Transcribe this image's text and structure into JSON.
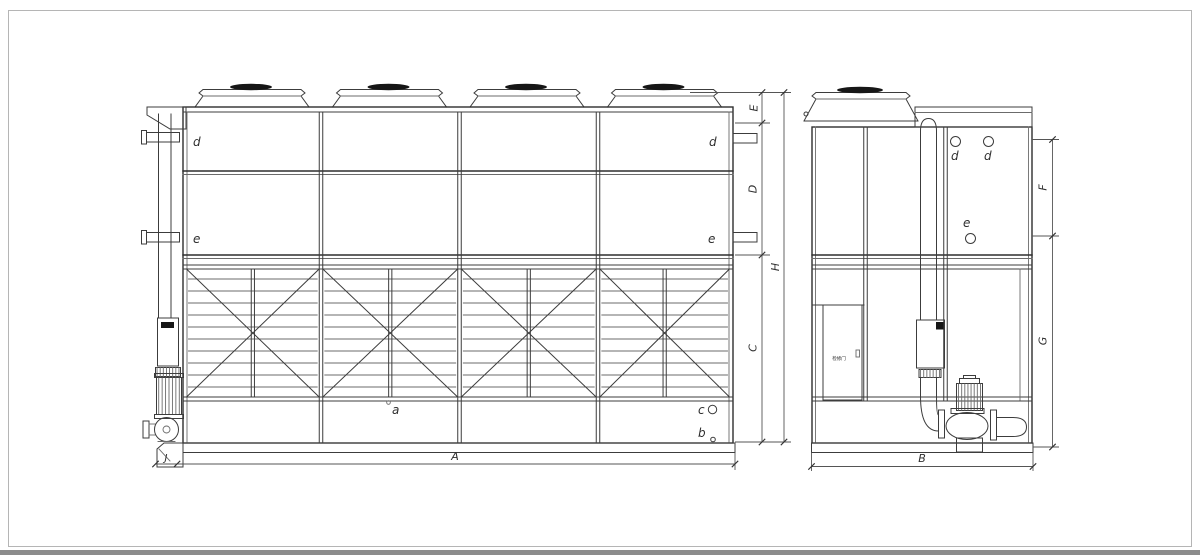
{
  "labels": {
    "dim_A": "A",
    "dim_B": "B",
    "dim_C": "C",
    "dim_D": "D",
    "dim_E": "E",
    "dim_F": "F",
    "dim_G": "G",
    "dim_H": "H",
    "dim_J": "J",
    "conn_d_front_left": "d",
    "conn_e_front_left": "e",
    "conn_d_front_right": "d",
    "conn_e_front_right": "e",
    "conn_d_side_1": "d",
    "conn_d_side_2": "d",
    "conn_e_side": "e",
    "point_a": "a",
    "point_b": "b",
    "point_c": "c",
    "door": "检修门"
  },
  "colors": {
    "background": "#ffffff",
    "line": "#2e2e2e",
    "thin_line": "#6b6b6b",
    "dimension": "#555555",
    "fan_hub": "#161616"
  }
}
